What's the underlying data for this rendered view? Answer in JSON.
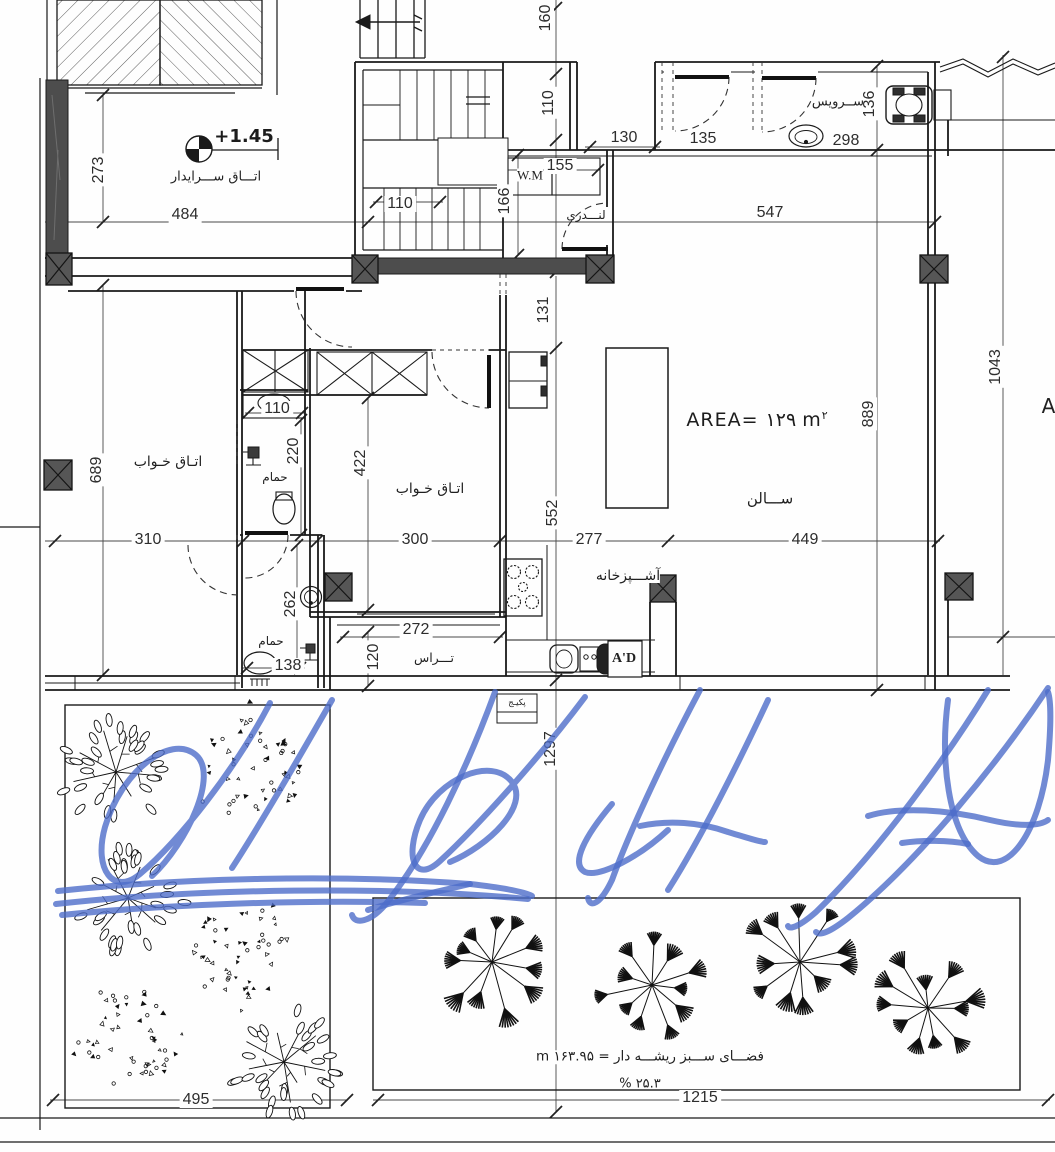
{
  "drawing": {
    "level_marker": "+1.45",
    "area_label": "AREA= ۱۲۹ m",
    "area_sup": "٢",
    "partial_letter": "A",
    "green_space_label": "فضـــای ســـبز ریشـــه دار = ۱۶۳.۹۵ m",
    "green_space_percent": "۲۵.۳ %",
    "sink_brand": "A'D",
    "wm_label": "W.M"
  },
  "rooms": {
    "janitor": "اتـــاق ســـرایدار",
    "service": "ســرویس",
    "laundry": "لنـــدری",
    "bedroom1": "اتـاق خـواب",
    "bedroom2": "اتـاق خـواب",
    "bath1": "حمام",
    "bath2": "حمام",
    "salon": "ســـالن",
    "kitchen": "آشـــپزخانه",
    "terrace": "تـــراس",
    "boiler": "پکیـج"
  },
  "dims": {
    "d160": "160",
    "d110_shaft": "110",
    "d130": "130",
    "d135": "135",
    "d298": "298",
    "d136": "136",
    "d547": "547",
    "d155": "155",
    "d166": "166",
    "d110_stair": "110",
    "d273": "273",
    "d484": "484",
    "d131": "131",
    "d689": "689",
    "d110_bath": "110",
    "d220": "220",
    "d422": "422",
    "d310": "310",
    "d300": "300",
    "d277": "277",
    "d449": "449",
    "d552": "552",
    "d889": "889",
    "d1043": "1043",
    "d262": "262",
    "d272": "272",
    "d120": "120",
    "d138": "138",
    "d1297": "1297",
    "d495": "495",
    "d1215": "1215"
  }
}
